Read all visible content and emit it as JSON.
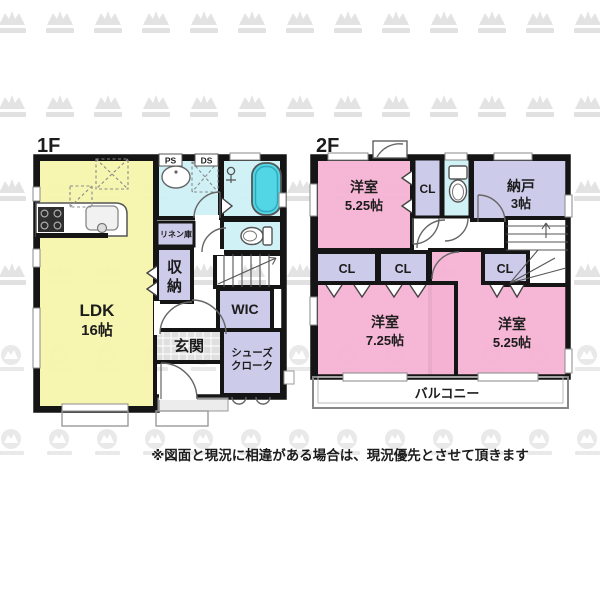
{
  "floors": {
    "f1": {
      "label": "1F",
      "rooms": {
        "ldk": {
          "name": "LDK",
          "size": "16帖"
        },
        "shuno": {
          "line1": "収",
          "line2": "納"
        },
        "wic": "WIC",
        "genkan": "玄関",
        "shoes": {
          "line1": "シューズ",
          "line2": "クローク"
        },
        "linen": "リネン庫",
        "ps": "PS",
        "ds": "DS"
      }
    },
    "f2": {
      "label": "2F",
      "rooms": {
        "room_a": {
          "name": "洋室",
          "size": "5.25帖"
        },
        "cl_top": "CL",
        "nando": {
          "name": "納戸",
          "size": "3帖"
        },
        "cl_left": "CL",
        "cl_mid": "CL",
        "cl_right": "CL",
        "room_b": {
          "name": "洋室",
          "size": "7.25帖"
        },
        "room_c": {
          "name": "洋室",
          "size": "5.25帖"
        },
        "balcony": "バルコニー"
      }
    }
  },
  "disclaimer": "※図面と現況に相違がある場合は、現況優先とさせて頂きます",
  "colors": {
    "ldk_fill": "#f7f5ad",
    "bedroom_fill": "#f6b2d3",
    "closet_fill": "#ccccea",
    "wet_area_fill": "#cdf0f4",
    "bathtub_fill": "#52d5e4",
    "wall": "#151515",
    "watermark": "#e3e3e3"
  }
}
